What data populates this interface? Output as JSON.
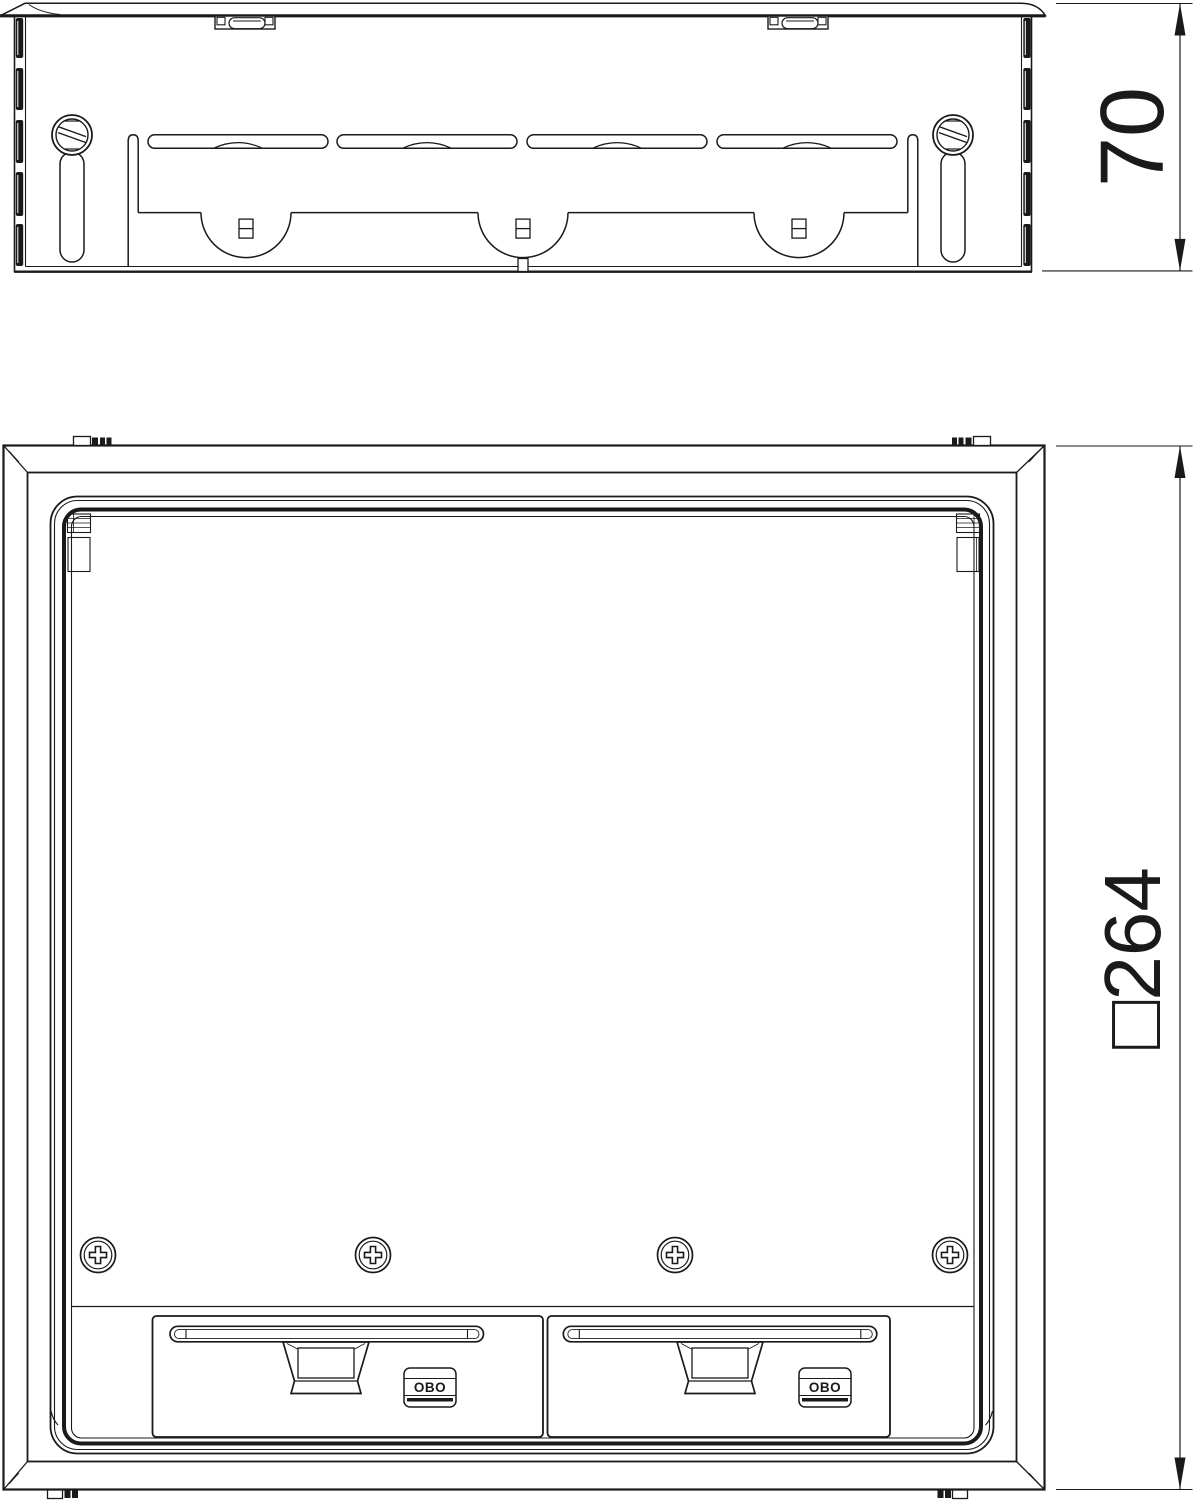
{
  "drawing": {
    "background": "#ffffff",
    "line_color": "#1a1a1a",
    "dimension_side_height": "70",
    "dimension_plan_size": "□264",
    "logo_text": "OBO"
  }
}
